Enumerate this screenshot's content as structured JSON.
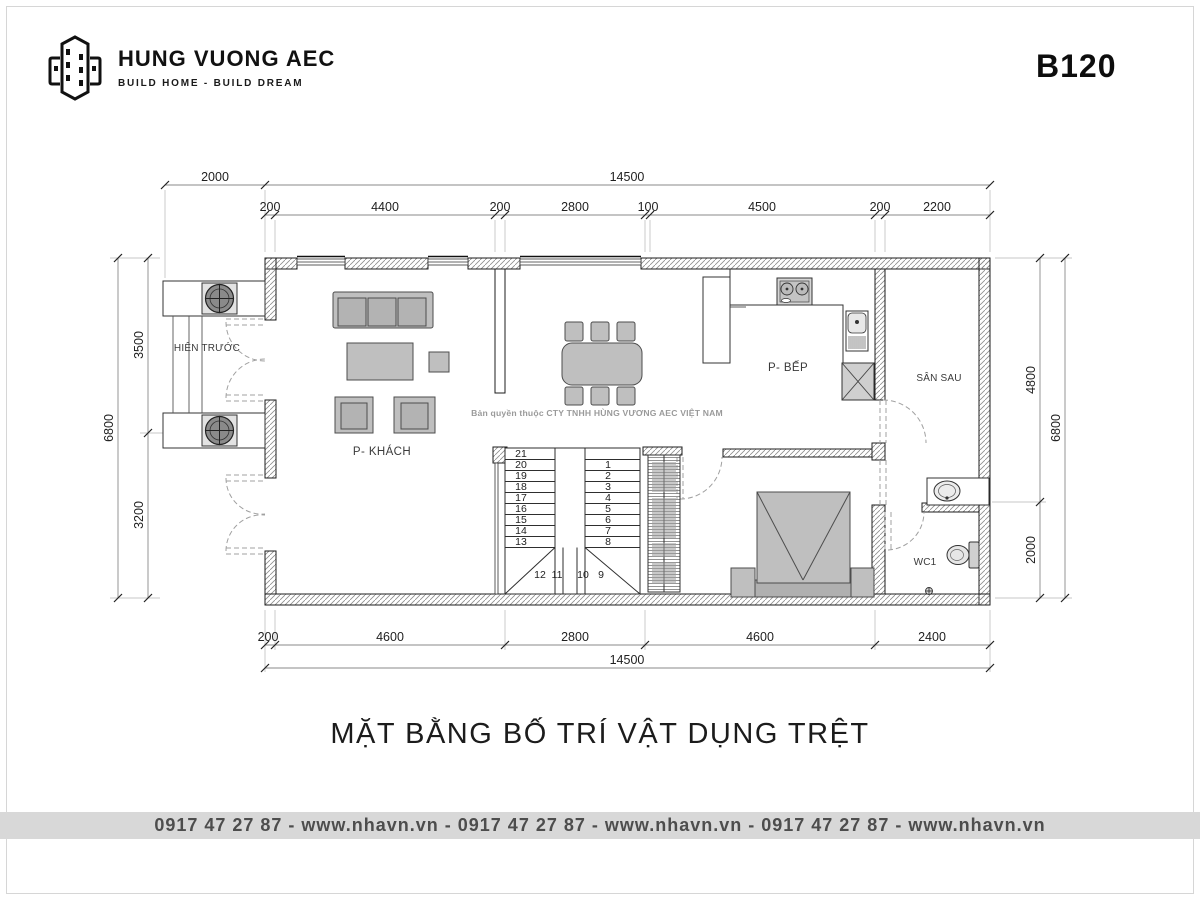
{
  "header": {
    "brand": "HUNG VUONG AEC",
    "tagline": "BUILD HOME - BUILD DREAM",
    "code": "B120"
  },
  "plan": {
    "rooms": {
      "porch": "HIÊN TRƯỚC",
      "living": "P- KHÁCH",
      "kitchen": "P- BẾP",
      "backyard": "SÂN SAU",
      "wc": "WC1"
    },
    "watermark": "Bản quyền thuộc CTY TNHH HÙNG VƯƠNG AEC VIỆT NAM",
    "dims": {
      "top_outer": [
        "2000",
        "14500"
      ],
      "top_inner": [
        "200",
        "4400",
        "200",
        "2800",
        "100",
        "4500",
        "200",
        "2200"
      ],
      "left_outer": "6800",
      "left_inner": [
        "3500",
        "3200"
      ],
      "right_inner": [
        "4800",
        "2000"
      ],
      "right_outer": "6800",
      "bottom_inner": [
        "200",
        "4600",
        "2800",
        "4600",
        "2400"
      ],
      "bottom_outer": "14500"
    },
    "stairs": {
      "left": [
        "21",
        "20",
        "19",
        "18",
        "17",
        "16",
        "15",
        "14",
        "13"
      ],
      "winders": [
        "12",
        "11",
        "10",
        "9"
      ],
      "right": [
        "1",
        "2",
        "3",
        "4",
        "5",
        "6",
        "7",
        "8"
      ]
    }
  },
  "title": "MẶT BẰNG BỐ TRÍ VẬT DỤNG TRỆT",
  "footer": "0917 47 27 87 - www.nhavn.vn - 0917 47 27 87 - www.nhavn.vn - 0917 47 27 87 - www.nhavn.vn",
  "colors": {
    "furniture": "#bfbfbf",
    "wall_outline": "#1c1c1c",
    "dim_line": "#8a8a8a",
    "door_dash": "#a0a0a0",
    "watermark": "#9a9a9a",
    "footer_bg": "#d8d8d8"
  }
}
